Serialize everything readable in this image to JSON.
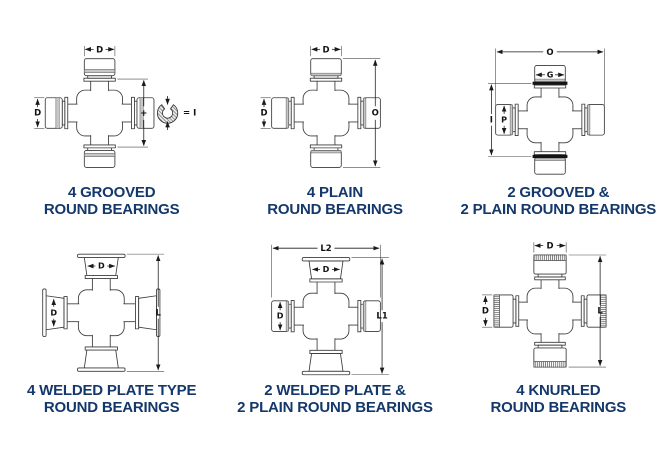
{
  "colors": {
    "caption": "#14386b",
    "line": "#3a3a3a",
    "groove_band": "#c6c6c6",
    "snap_ring": "#141414",
    "background": "#ffffff"
  },
  "diagrams": [
    {
      "name": "4-grooved-round-bearings",
      "bearing_style": "grooved on all four cups",
      "caption": [
        "4 GROOVED",
        "ROUND BEARINGS"
      ],
      "labels": {
        "top_width": "D",
        "left_height": "D",
        "right_plus": "+",
        "ring_equals": "= I"
      }
    },
    {
      "name": "4-plain-round-bearings",
      "bearing_style": "plain on all four cups",
      "caption": [
        "4 PLAIN",
        "ROUND BEARINGS"
      ],
      "labels": {
        "top_width": "D",
        "left_height": "D",
        "right_span": "O"
      }
    },
    {
      "name": "2-grooved-2-plain-round-bearings",
      "bearing_style": "grooved snap-ring on vertical cups, plain on horizontal cups",
      "caption": [
        "2 GROOVED &",
        "2 PLAIN ROUND BEARINGS"
      ],
      "labels": {
        "overall_width": "O",
        "cup_width": "G",
        "left_span": "I",
        "cup_inner": "P"
      }
    },
    {
      "name": "4-welded-plate-round-bearings",
      "bearing_style": "welded plate on all four cups",
      "caption": [
        "4 WELDED PLATE TYPE",
        "ROUND BEARINGS"
      ],
      "labels": {
        "cup_width": "D",
        "cup_height": "D",
        "length": "L"
      }
    },
    {
      "name": "2-welded-plate-2-plain-round-bearings",
      "bearing_style": "welded plate on vertical cups, plain on horizontal cups",
      "caption": [
        "2 WELDED PLATE &",
        "2 PLAIN ROUND BEARINGS"
      ],
      "labels": {
        "overall_width": "L2",
        "cup_width": "D",
        "cup_height": "D",
        "length": "L1"
      }
    },
    {
      "name": "4-knurled-round-bearings",
      "bearing_style": "knurled band on outer end of all four cups",
      "caption": [
        "4 KNURLED",
        "ROUND BEARINGS"
      ],
      "labels": {
        "top_width": "D",
        "left_height": "D",
        "length": "L"
      }
    }
  ]
}
